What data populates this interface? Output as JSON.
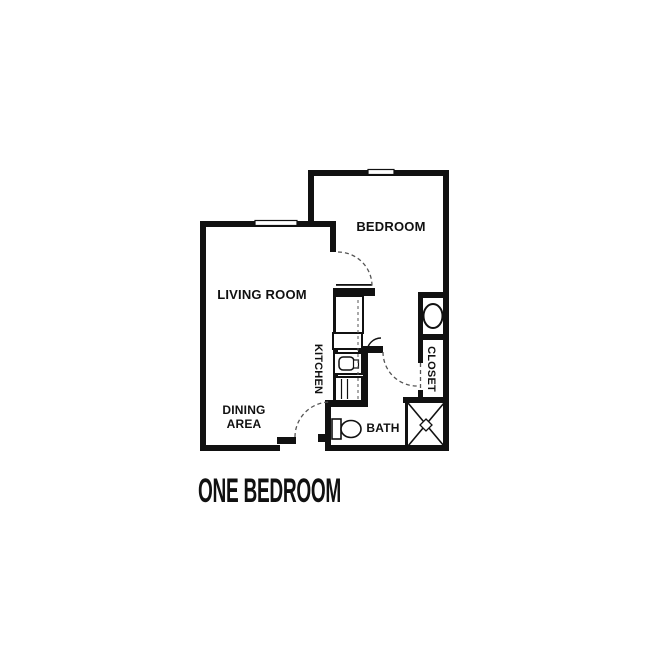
{
  "page": {
    "background": "#ffffff"
  },
  "floor_plan": {
    "title": "ONE BEDROOM",
    "rooms": {
      "bedroom": {
        "label": "BEDROOM"
      },
      "living_room": {
        "label": "LIVING ROOM"
      },
      "dining_area": {
        "label_line1": "DINING",
        "label_line2": "AREA"
      },
      "kitchen": {
        "label": "KITCHEN"
      },
      "bath": {
        "label": "BATH"
      },
      "closet": {
        "label": "CLOSET"
      }
    },
    "icons": {
      "toilet": "toilet-icon",
      "shower": "shower-x-icon",
      "vanity_sink": "vanity-sink-icon",
      "kitchen_sink": "kitchen-sink-icon",
      "stove": "stove-icon",
      "window": "window-icon"
    },
    "colors": {
      "wall": "#111111",
      "text": "#111111",
      "background": "#ffffff"
    }
  }
}
